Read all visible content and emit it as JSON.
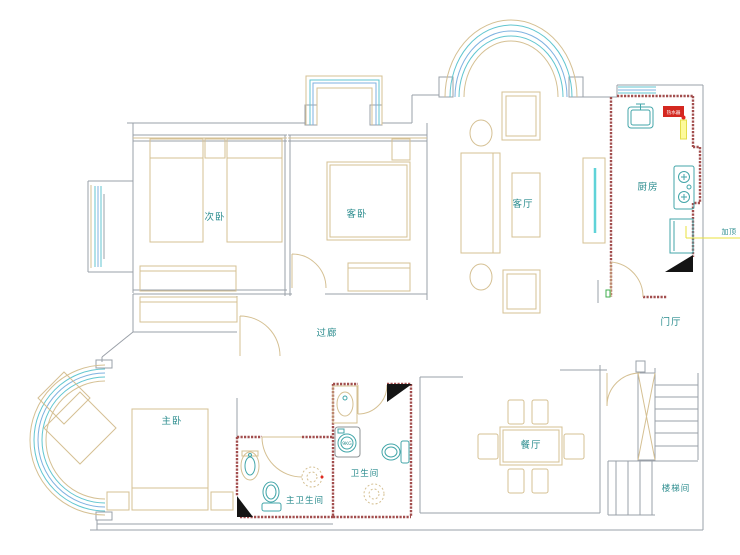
{
  "labels": {
    "secondary_bedroom": "次卧",
    "guest_bedroom": "客卧",
    "living_room": "客厅",
    "kitchen": "厨房",
    "entry_hall": "门厅",
    "corridor": "过廊",
    "master_bedroom": "主卧",
    "dining_room": "餐厅",
    "stairwell": "楼梯间",
    "master_bathroom": "主卫生间",
    "bathroom": "卫生间"
  },
  "annotations": {
    "ceiling_note": "加顶",
    "water_heater": "热水器",
    "washer_capacity": "9KG"
  },
  "colors": {
    "wall_gray": "#9aa0a8",
    "furniture_tan": "#d5c093",
    "fixture_teal": "#43a6a9",
    "window_cyan": "#62c6d0",
    "window_blue": "#7fb2e0",
    "new_wall_red": "#a24e4e",
    "label_teal": "#2b8c8e",
    "accent_yellow": "#e8e23c",
    "alert_red": "#d42820",
    "hinge_green": "#3fae4e",
    "column_black": "#141414"
  }
}
